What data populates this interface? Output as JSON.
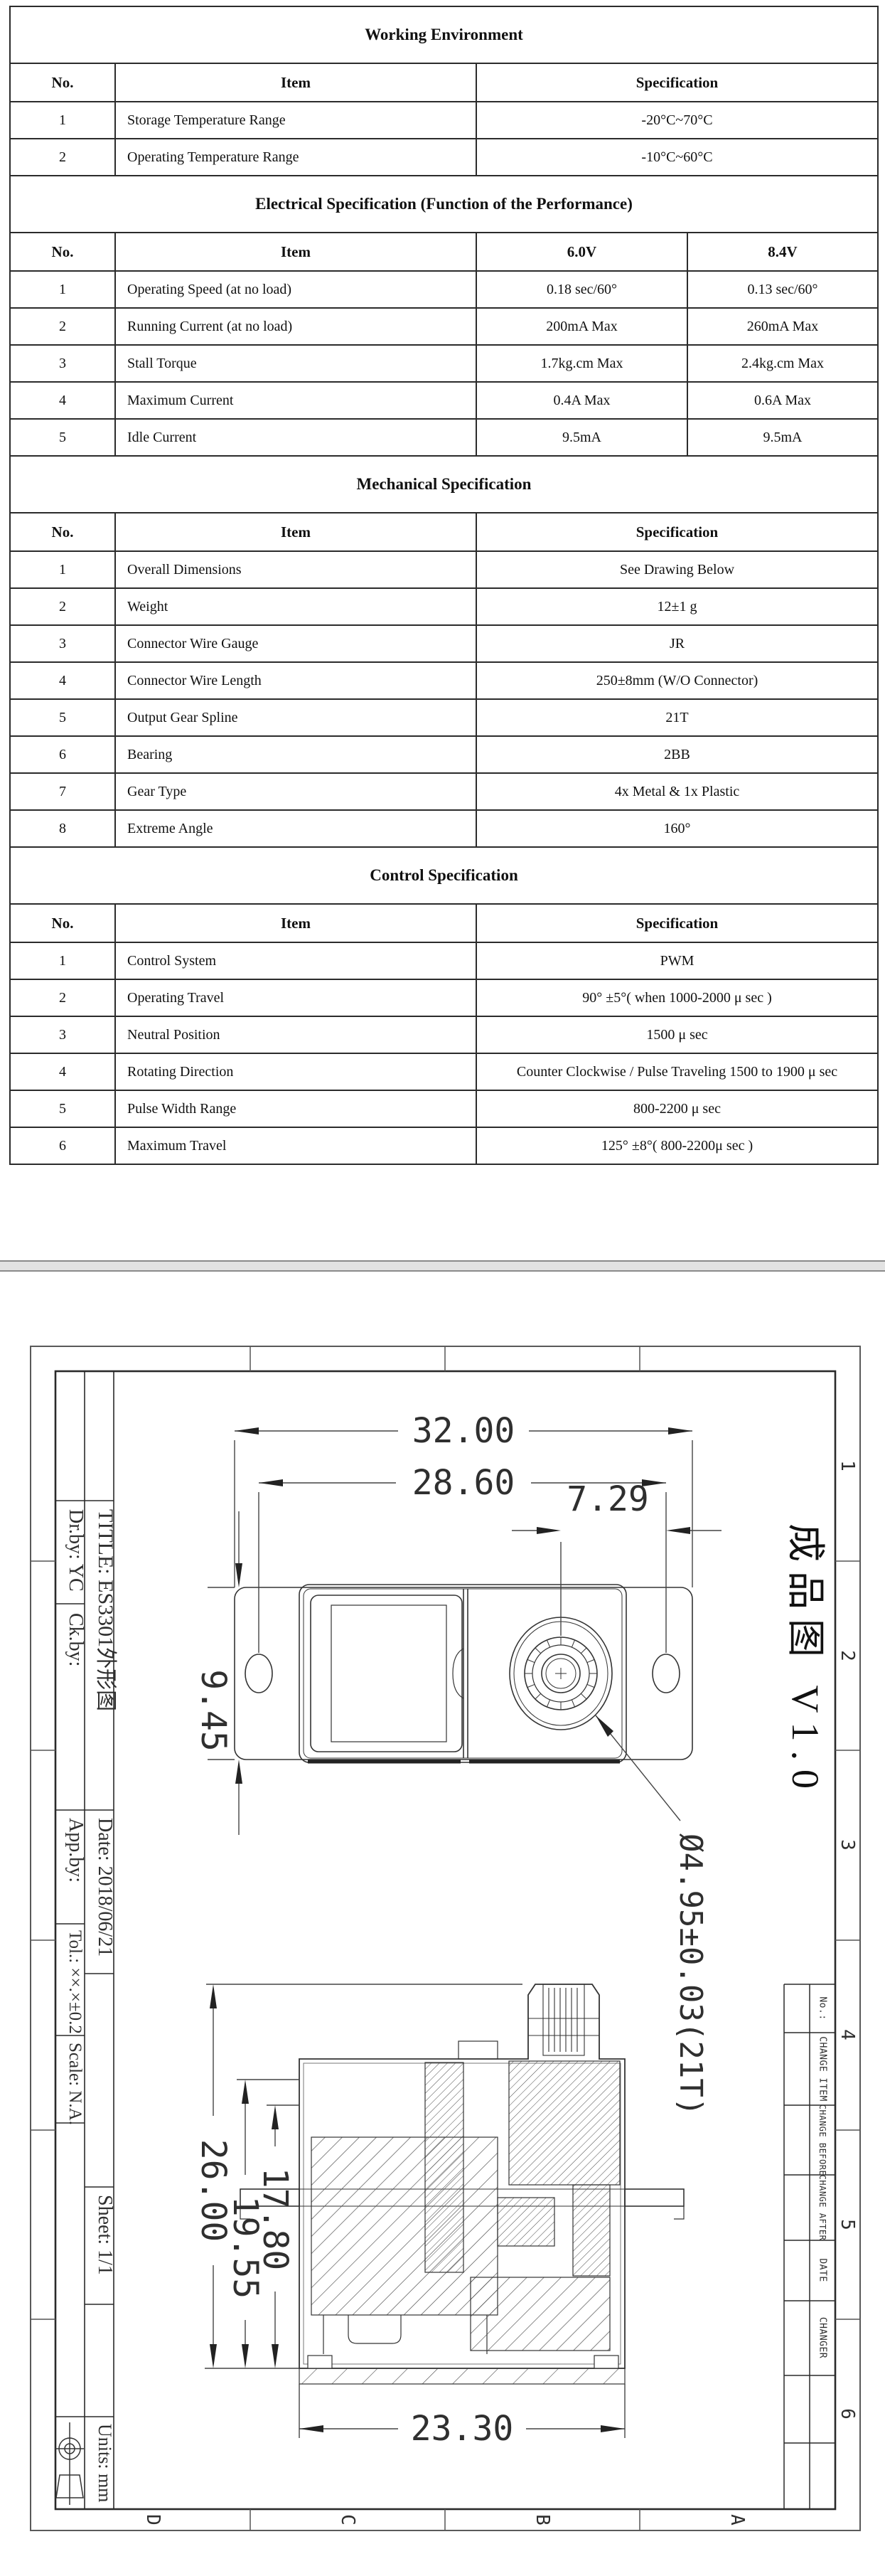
{
  "page1": {
    "tables": [
      {
        "title": "Working Environment",
        "headers": [
          "No.",
          "Item",
          "Specification"
        ],
        "rows": [
          [
            "1",
            "Storage Temperature Range",
            "-20°C~70°C"
          ],
          [
            "2",
            "Operating Temperature Range",
            "-10°C~60°C"
          ]
        ]
      },
      {
        "title": "Electrical Specification (Function of the Performance)",
        "headers": [
          "No.",
          "Item",
          "6.0V",
          "8.4V"
        ],
        "rows": [
          [
            "1",
            "Operating Speed (at no load)",
            "0.18 sec/60°",
            "0.13 sec/60°"
          ],
          [
            "2",
            "Running Current (at no load)",
            "200mA Max",
            "260mA Max"
          ],
          [
            "3",
            "Stall Torque",
            "1.7kg.cm Max",
            "2.4kg.cm Max"
          ],
          [
            "4",
            "Maximum Current",
            "0.4A Max",
            "0.6A Max"
          ],
          [
            "5",
            "Idle Current",
            "9.5mA",
            "9.5mA"
          ]
        ]
      },
      {
        "title": "Mechanical Specification",
        "headers": [
          "No.",
          "Item",
          "Specification"
        ],
        "rows": [
          [
            "1",
            "Overall Dimensions",
            "See Drawing Below"
          ],
          [
            "2",
            "Weight",
            "12±1 g"
          ],
          [
            "3",
            "Connector Wire Gauge",
            "JR"
          ],
          [
            "4",
            "Connector Wire Length",
            "250±8mm (W/O Connector)"
          ],
          [
            "5",
            "Output Gear Spline",
            "21T"
          ],
          [
            "6",
            "Bearing",
            "2BB"
          ],
          [
            "7",
            "Gear Type",
            "4x Metal & 1x Plastic"
          ],
          [
            "8",
            "Extreme Angle",
            "160°"
          ]
        ]
      },
      {
        "title": "Control Specification",
        "headers": [
          "No.",
          "Item",
          "Specification"
        ],
        "rows": [
          [
            "1",
            "Control System",
            "PWM"
          ],
          [
            "2",
            "Operating Travel",
            "90° ±5°( when 1000-2000 μ sec )"
          ],
          [
            "3",
            "Neutral Position",
            "1500 μ sec"
          ],
          [
            "4",
            "Rotating Direction",
            "Counter Clockwise / Pulse Traveling 1500 to 1900 μ sec"
          ],
          [
            "5",
            "Pulse Width Range",
            "800-2200 μ sec"
          ],
          [
            "6",
            "Maximum Travel",
            "125° ±8°( 800-2200μ sec )"
          ]
        ]
      }
    ]
  },
  "sheet": {
    "version_label": "成品图 V1.0",
    "title_block": {
      "title": "TITLE: ES3301外形图",
      "dr_by": "Dr.by: YC",
      "ck_by": "Ck.by:",
      "app_by": "App.by:",
      "date": "Date: 2018/06/21",
      "tolerance": "Tol.: ××.×±0.2",
      "scale": "Scale: N.A.",
      "sheet_no": "Sheet: 1/1",
      "units": "Units: mm"
    },
    "revision_table": {
      "headers": [
        "No.:",
        "CHANGE ITEM",
        "CHANGE BEFORE",
        "CHANGE AFTER",
        "DATE",
        "CHANGER"
      ]
    },
    "grid": {
      "numbers": [
        "1",
        "2",
        "3",
        "4",
        "5",
        "6"
      ],
      "letters": [
        "D",
        "C",
        "B",
        "A"
      ]
    },
    "plan_dims": {
      "width": "32.00",
      "hole_span": "28.60",
      "shaft_offset": "7.29",
      "depth": "9.45",
      "spline": "Ø4.95±0.03(21T)"
    },
    "section_dims": {
      "total_height": "26.00",
      "mid_height": "19.55",
      "inner_height": "17.80",
      "body_width": "23.30"
    }
  }
}
